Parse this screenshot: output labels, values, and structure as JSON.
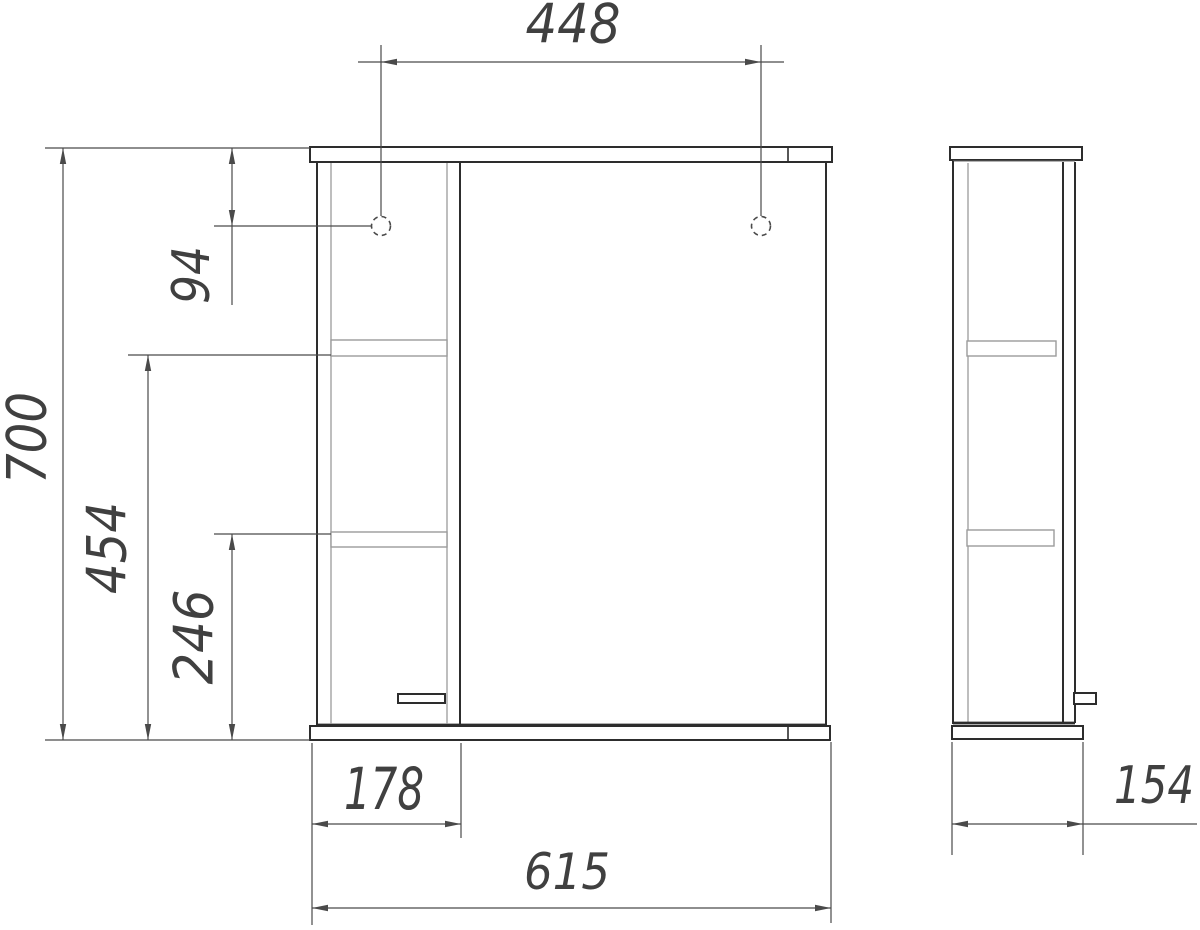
{
  "dimensions": {
    "hole_spacing": "448",
    "overall_height": "700",
    "hole_top_offset": "94",
    "upper_shelf_to_bottom": "454",
    "lower_shelf_to_bottom": "246",
    "shelf_section_width": "178",
    "overall_width": "615",
    "overall_depth": "154"
  },
  "colors": {
    "background": "#ffffff",
    "outline": "#2d2d2d",
    "inner_gray": "#9b9b9b",
    "dimension_line": "#4a4a4a",
    "dimension_text": "#404040"
  }
}
